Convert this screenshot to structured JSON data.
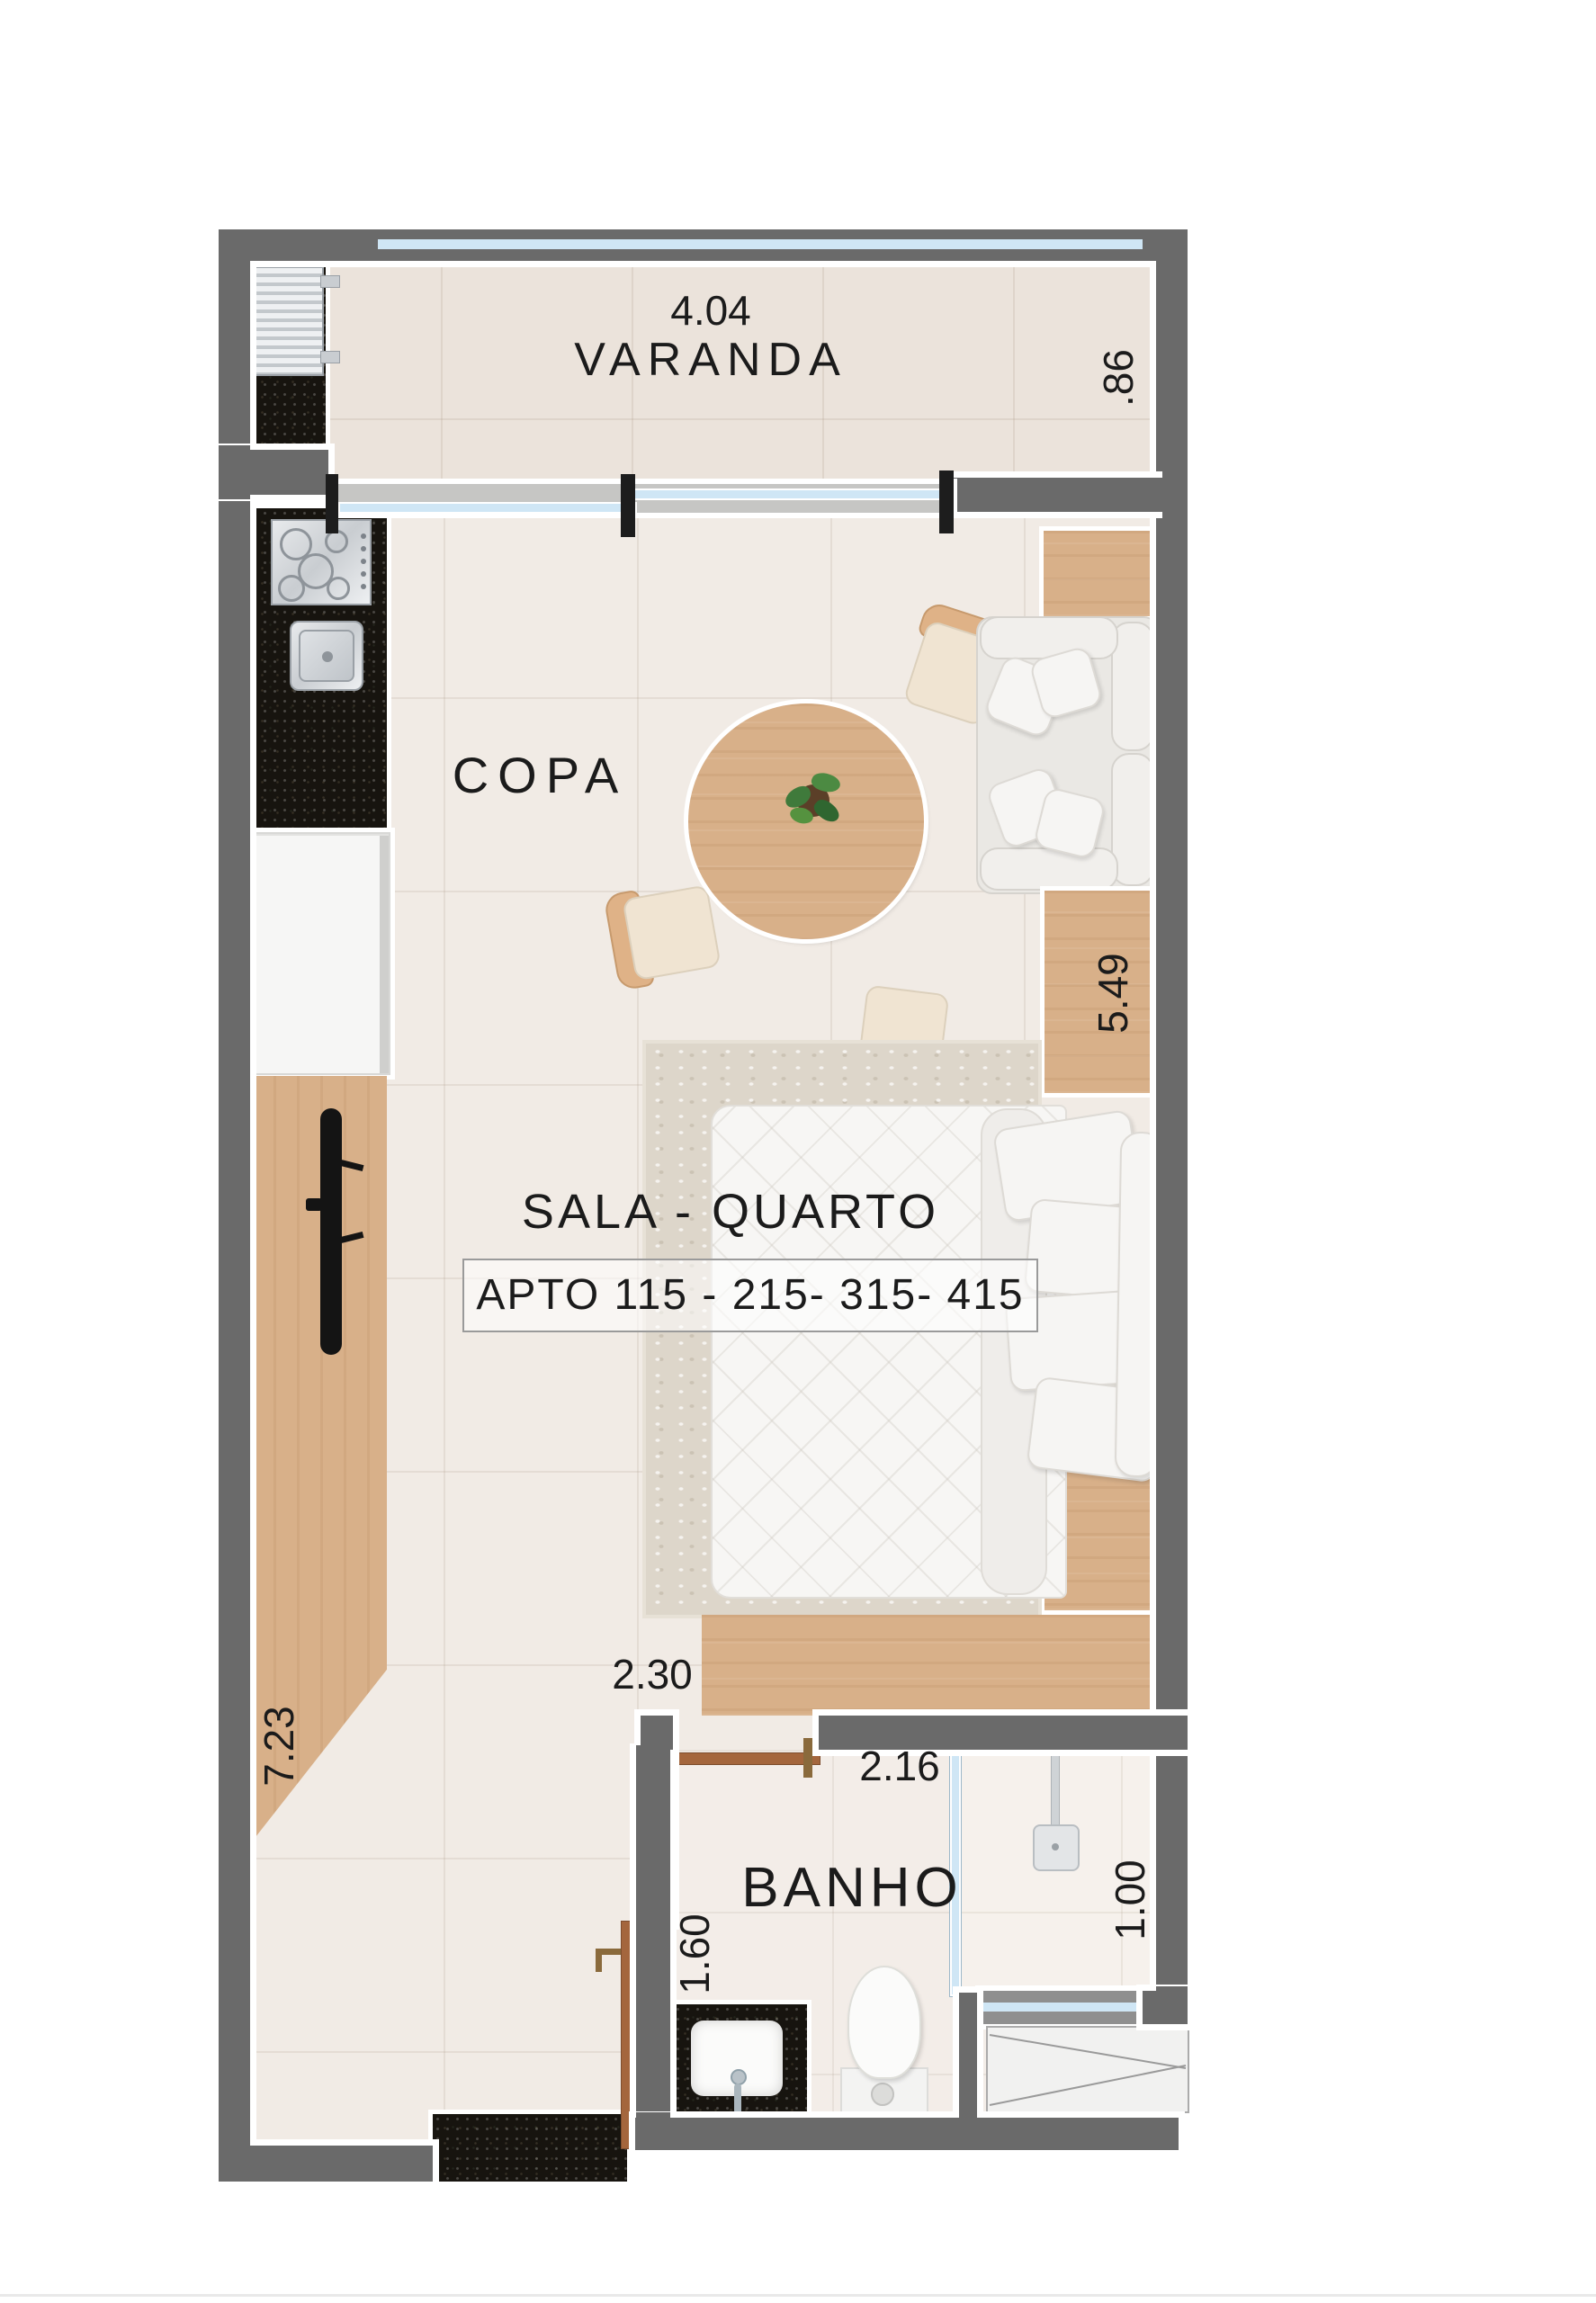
{
  "rooms": {
    "varanda": {
      "label": "VARANDA",
      "width_dim": "4.04",
      "depth_dim": ".86"
    },
    "copa": {
      "label": "COPA"
    },
    "sala_quarto": {
      "label": "SALA - QUARTO",
      "apto_line": "APTO 115 - 215- 315- 415",
      "right_dim": "5.49",
      "left_dim": "7.23",
      "hall_dim": "2.30"
    },
    "banho": {
      "label": "BANHO",
      "width_dim": "2.16",
      "entry_dim": "1.60",
      "shower_dim": "1.00"
    }
  },
  "colors": {
    "wall": "#6a6a6a",
    "floor_tile": "#f1ebe5",
    "varanda_tile": "#ebe3db",
    "granite": "#17140f",
    "wood": "#d8b089",
    "glass": "#cfe6f5",
    "text": "#1b1b1b"
  },
  "icons": [
    "laundry-tank-icon",
    "cooktop-icon",
    "kitchen-sink-icon",
    "refrigerator-icon",
    "tv-icon",
    "dining-table-icon",
    "plant-icon",
    "chair-icon",
    "sideboard-icon",
    "sofa-icon",
    "nightstand-icon",
    "bed-icon",
    "rug-icon",
    "entry-door-icon",
    "bathroom-door-icon",
    "vanity-sink-icon",
    "toilet-icon",
    "shower-head-icon",
    "glass-partition-icon",
    "window-icon"
  ]
}
